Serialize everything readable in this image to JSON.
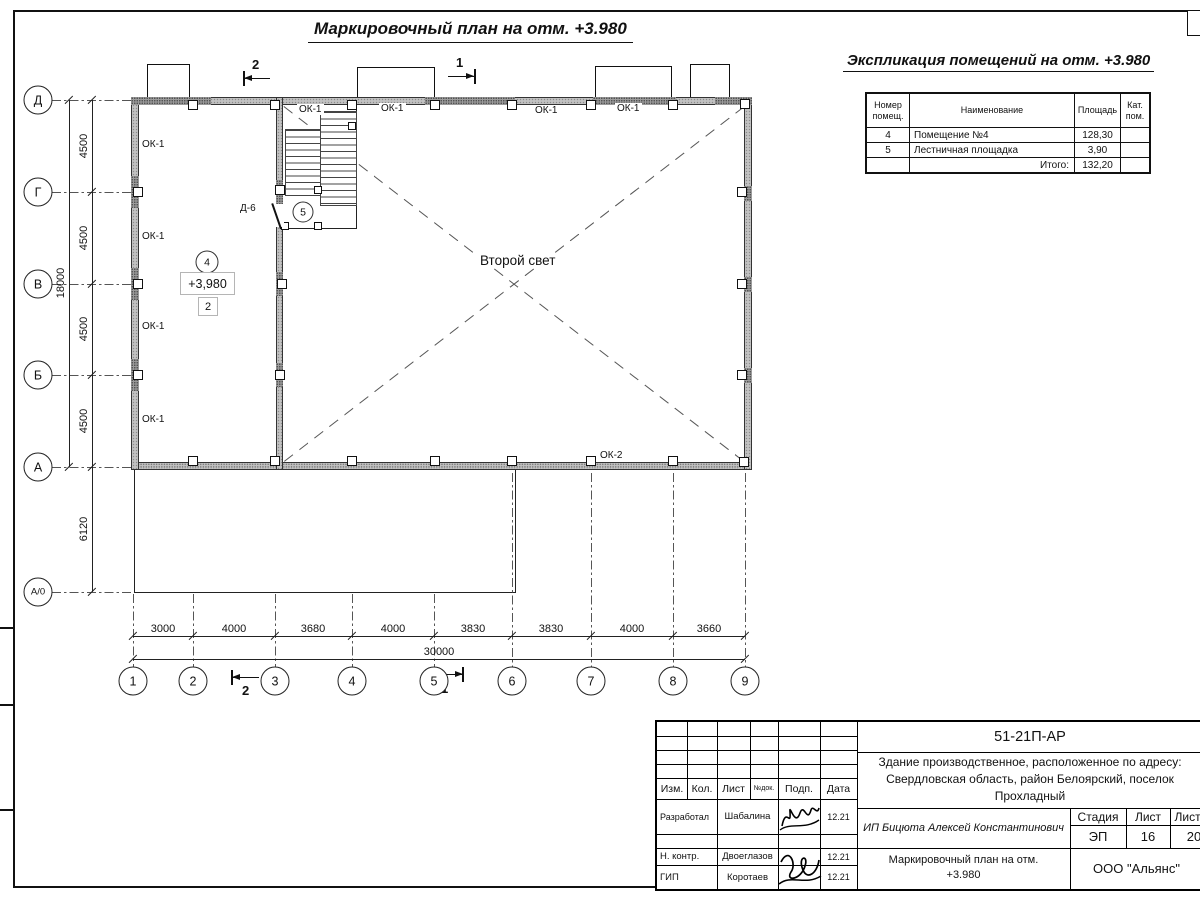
{
  "page_title": "Маркировочный план на отм. +3.980",
  "explication": {
    "title": "Экспликация помещений на отм. +3.980",
    "columns": {
      "number_l1": "Номер",
      "number_l2": "помещ.",
      "name": "Наименование",
      "area": "Площадь",
      "cat_l1": "Кат.",
      "cat_l2": "пом."
    },
    "rows": [
      {
        "number": "4",
        "name": "Помещение №4",
        "area": "128,30",
        "cat": ""
      },
      {
        "number": "5",
        "name": "Лестничная площадка",
        "area": "3,90",
        "cat": ""
      }
    ],
    "total_label": "Итого:",
    "total_area": "132,20"
  },
  "plan": {
    "row_axes": [
      "Д",
      "Г",
      "В",
      "Б",
      "А",
      "А/0"
    ],
    "col_axes": [
      "1",
      "2",
      "3",
      "4",
      "5",
      "6",
      "7",
      "8",
      "9"
    ],
    "dims_left": [
      "4500",
      "4500",
      "4500",
      "4500"
    ],
    "dim_left_total": "18000",
    "dim_annex": "6120",
    "dims_bottom": [
      "3000",
      "4000",
      "3680",
      "4000",
      "3830",
      "3830",
      "4000",
      "3660"
    ],
    "dim_bottom_total": "30000",
    "window_ok1": "ОК-1",
    "window_ok2": "ОК-2",
    "door_label": "Д-6",
    "room4_number": "4",
    "room5_number": "5",
    "elevation_mark": "+3,980",
    "zone_mark": "2",
    "void_label": "Второй свет",
    "section_mark_1": "1",
    "section_mark_2": "2"
  },
  "title_block": {
    "doc_number": "51-21П-АР",
    "project_line1": "Здание производственное, расположенное по адресу:",
    "project_line2": "Свердловская область, район Белоярский, поселок",
    "project_line3": "Прохладный",
    "client": "ИП Бицюта Алексей Константинович",
    "stage_label": "Стадия",
    "sheet_label": "Лист",
    "sheets_label": "Листов",
    "stage": "ЭП",
    "sheet": "16",
    "sheets": "20",
    "drawing_title_line1": "Маркировочный план на отм.",
    "drawing_title_line2": "+3.980",
    "company": "ООО \"Альянс\"",
    "header_cols": [
      "Изм.",
      "Кол.",
      "Лист",
      "№док.",
      "Подп.",
      "Дата"
    ],
    "rows": [
      {
        "role": "Разработал",
        "name": "Шабалина",
        "date": "12.21"
      },
      {
        "role": "Н. контр.",
        "name": "Двоеглазов",
        "date": "12.21"
      },
      {
        "role": "ГИП",
        "name": "Коротаев",
        "date": "12.21"
      }
    ]
  }
}
